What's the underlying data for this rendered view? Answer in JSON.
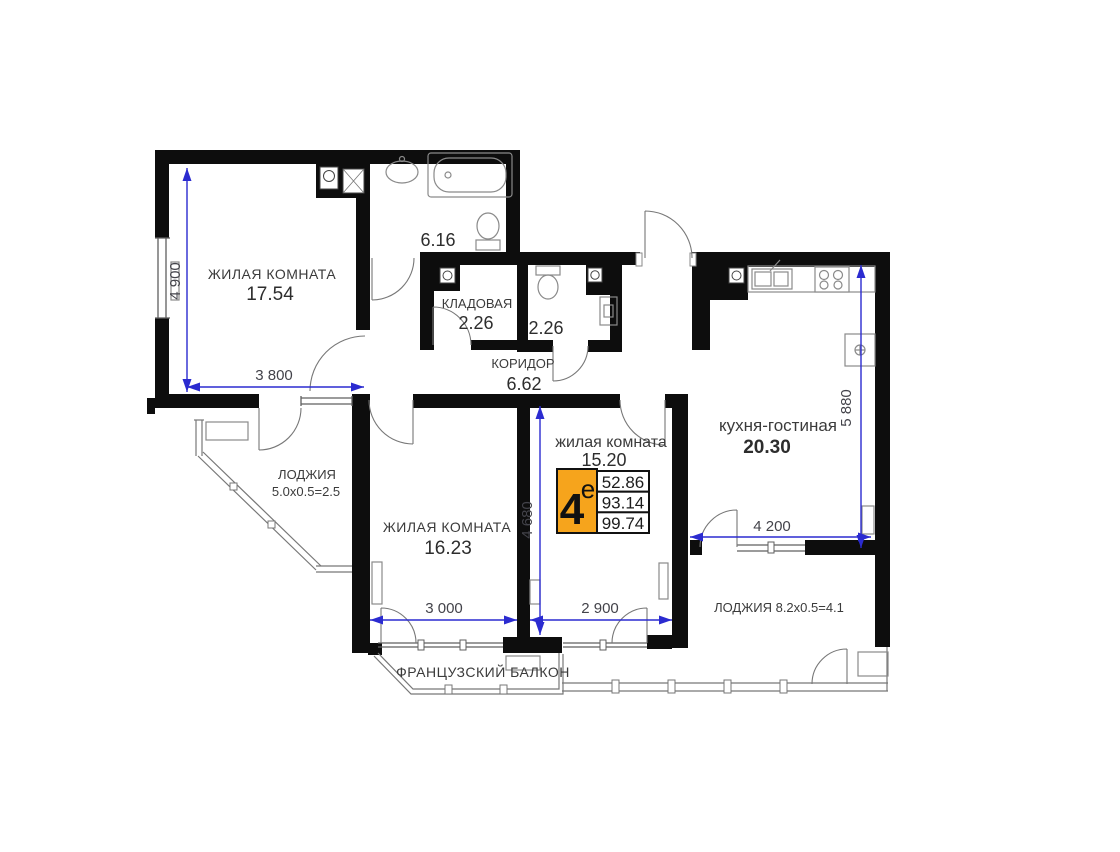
{
  "plan": {
    "rooms": {
      "living1": {
        "label": "ЖИЛАЯ КОМНАТА",
        "area": "17.54"
      },
      "bathroom": {
        "area": "6.16"
      },
      "storage": {
        "label": "КЛАДОВАЯ",
        "area": "2.26"
      },
      "wc": {
        "area": "2.26"
      },
      "corridor": {
        "label": "КОРИДОР",
        "area": "6.62"
      },
      "loggia_left": {
        "label": "ЛОДЖИЯ",
        "size": "5.0х0.5=2.5"
      },
      "living2": {
        "label": "ЖИЛАЯ КОМНАТА",
        "area": "16.23"
      },
      "living3": {
        "label": "жилая комната",
        "area": "15.20"
      },
      "kitchen": {
        "label": "кухня-гостиная",
        "area": "20.30"
      },
      "loggia_right": {
        "label": "ЛОДЖИЯ 8.2х0.5=4.1"
      },
      "french_balcony": {
        "label": "ФРАНЦУЗСКИЙ БАЛКОН"
      }
    },
    "dimensions": {
      "left_height": "4 900",
      "living1_width": "3 800",
      "living3_height": "4 680",
      "living2_width": "3 000",
      "living3_width": "2 900",
      "kitchen_height": "5 880",
      "kitchen_width": "4 200"
    },
    "badge": {
      "number": "4",
      "superscript": "е",
      "values": [
        "52.86",
        "93.14",
        "99.74"
      ]
    },
    "colors": {
      "wall": "#0d0d0d",
      "dimension": "#2b2bd0",
      "badge_orange": "#f6a41c"
    }
  }
}
